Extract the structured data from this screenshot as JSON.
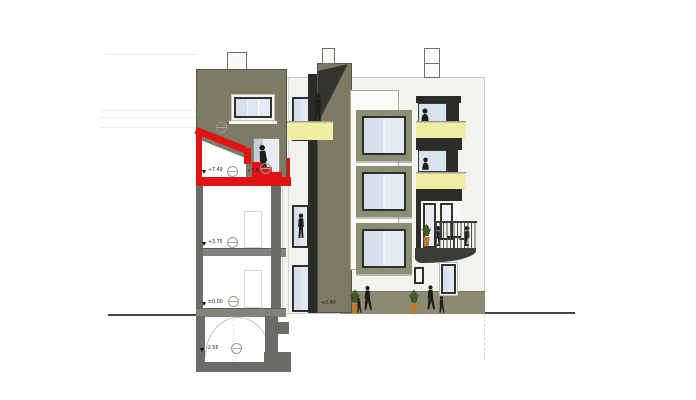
{
  "drawing": {
    "kind": "architectural section-elevation of a four-storey building with red-highlighted attic addition",
    "annotations": {
      "level_attic_left": "+7.49",
      "level_attic_right": "+7.63",
      "level_floor1": "+3.75",
      "level_ground": "±0.00",
      "level_basement": "-2.56",
      "level_tower_base": "+0.40"
    },
    "colors": {
      "facade_white": "#f3f3f0",
      "panel_white": "#fbfbf9",
      "olive_wall": "#7c7b65",
      "olive_ground_band": "#8b8a72",
      "olive_window_frame": "#8e8d75",
      "dark_recess": "#2b2b28",
      "cut_wall_gray": "#6b6b67",
      "slab_gray": "#83837d",
      "glass_blue": "#dce5f0",
      "balcony_yellow": "#f2eda5",
      "highlight_red": "#df1311",
      "silhouette_black": "#1d1d1b",
      "pot_orange": "#bf7a31",
      "plant_green": "#41592b"
    },
    "figures": [
      "person-climbing-attic-stairs",
      "person-standing-on-tower-balcony",
      "person-standing-in-bay-window",
      "person-at-upper-balcony-window",
      "person-at-middle-balcony-window",
      "two-people-seated-at-balcony-table",
      "adult-and-child-walking-left",
      "adult-and-child-walking-right",
      "potted-plant-ground-left",
      "potted-plant-ground-right",
      "potted-plant-on-balcony"
    ],
    "structures": [
      "chimney-left-block",
      "chimney-tower",
      "chimney-right-facade",
      "sloped-red-roof",
      "red-floor-slab",
      "red-stairs",
      "vaulted-basement-ceiling",
      "stepped-footing",
      "yellow-balcony-parapets",
      "cantilevered-balcony-with-railing",
      "grade-line-left",
      "grade-line-right",
      "neighbour-reference-lines"
    ]
  }
}
